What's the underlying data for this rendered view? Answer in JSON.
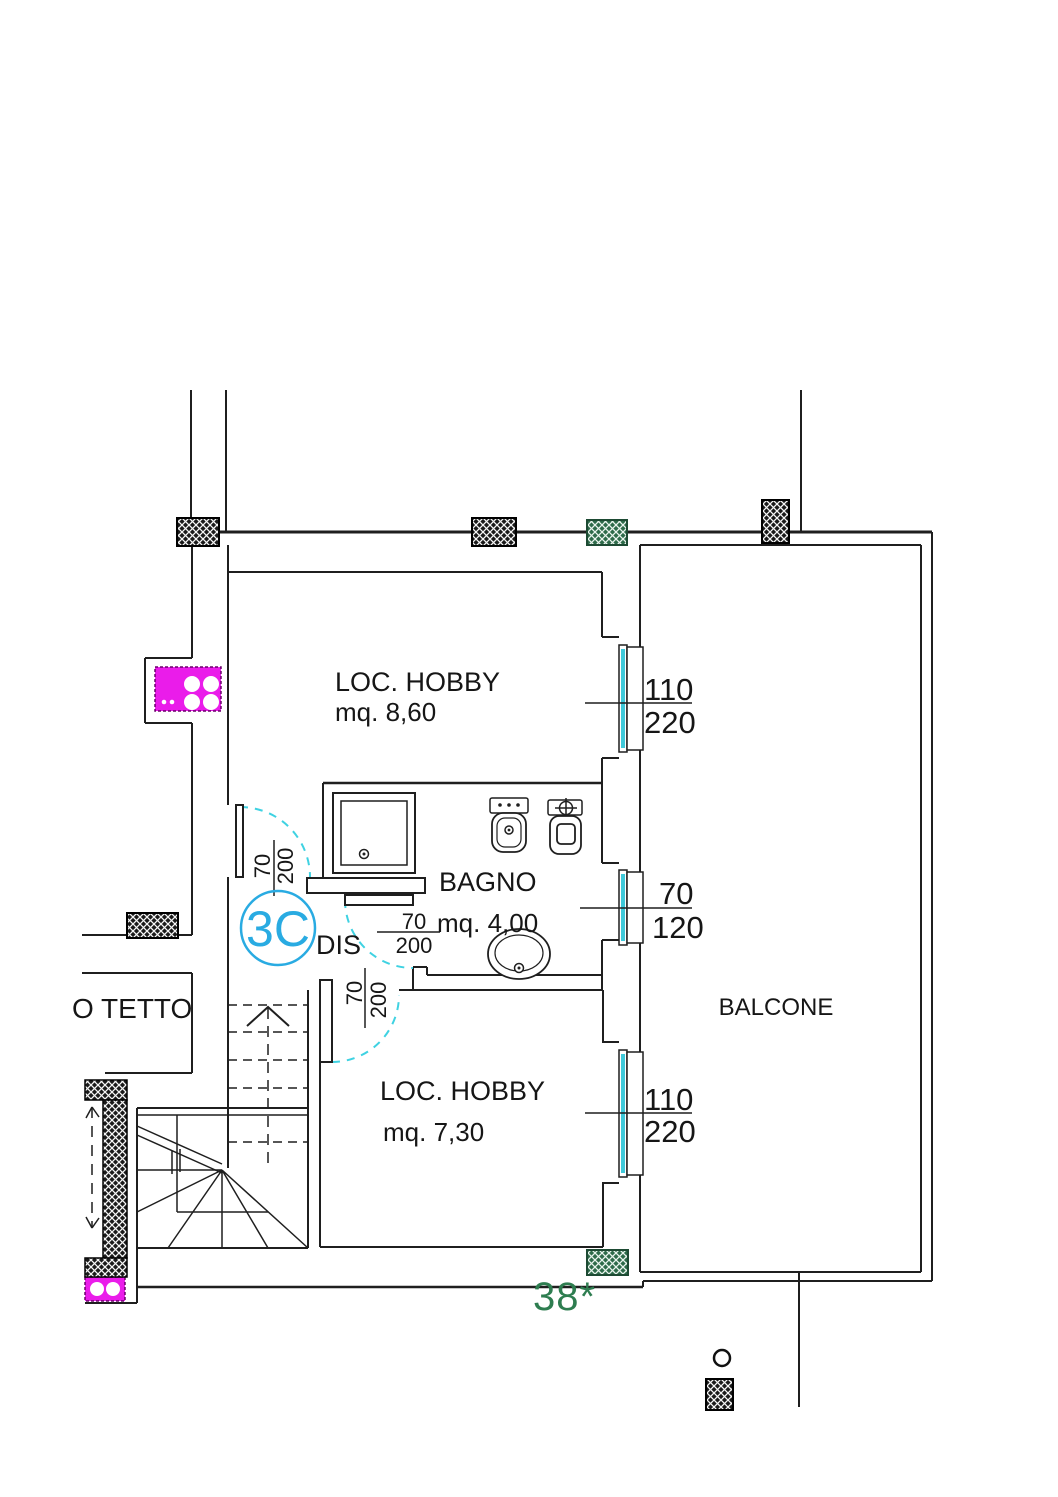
{
  "plan": {
    "unit_badge": "3C",
    "hall_label": "DIS",
    "note": "38*",
    "rooms": {
      "hobby_upper": {
        "name": "LOC. HOBBY",
        "area": "mq. 8,60"
      },
      "bagno": {
        "name": "BAGNO",
        "area": "mq. 4,00"
      },
      "hobby_lower": {
        "name": "LOC. HOBBY",
        "area": "mq. 7,30"
      },
      "balcone": {
        "name": "BALCONE"
      },
      "attic": {
        "name": "O TETTO"
      }
    },
    "openings": {
      "window_upper": {
        "w": "110",
        "h": "220"
      },
      "window_bagno": {
        "w": "70",
        "h": "120"
      },
      "window_lower": {
        "w": "110",
        "h": "220"
      },
      "door_dis": {
        "w": "70",
        "h": "200"
      },
      "door_bagno": {
        "w": "70",
        "h": "200"
      },
      "door_hobby": {
        "w": "70",
        "h": "200"
      }
    },
    "colors": {
      "line": "#1f1f1f",
      "door_arc": "#3fd2e2",
      "window_glass": "#3fc9da",
      "unit_badge_blue": "#29abe2",
      "fixture_magenta": "#ea1cea",
      "hatch_green": "#2e6b4a",
      "note_green": "#2e7d50"
    }
  }
}
